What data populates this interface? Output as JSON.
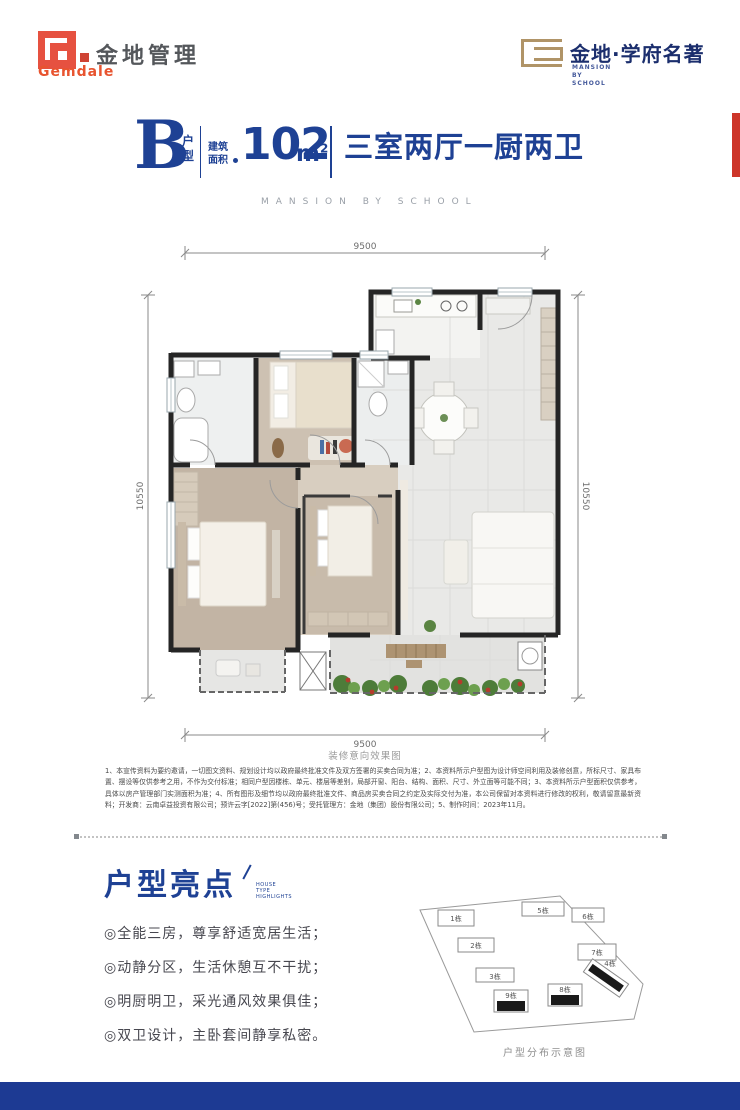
{
  "brand": {
    "gemdale_cn": "金地管理",
    "gemdale_en": "Gemdale",
    "project_name": "金地·学府名著",
    "project_lines": [
      "MANSION",
      "BY",
      "SCHOOL"
    ]
  },
  "title": {
    "type_letter": "B",
    "type_label": "户型",
    "area_label": "建筑面积",
    "area_value": "102",
    "area_unit_base": "m",
    "area_unit_sup": "2",
    "rooms": "三室两厅一厨两卫",
    "subtitle_en": "MANSION BY SCHOOL"
  },
  "floor_plan": {
    "dim_top": "9500",
    "dim_bottom": "9500",
    "dim_left": "10550",
    "dim_right": "10550",
    "caption": "装修意向效果图"
  },
  "disclaimer": {
    "text": "1、本宣传资料为要约邀请，一切图文资料、规划设计均以政府最终批准文件及双方签署的买卖合同为准；2、本资料所示户型图为设计师空间利用及装修创意，所标尺寸、家具布置、摆设等仅供参考之用，不作为交付标准；相同户型因楼栋、单元、楼层等差别，局部开窗、阳台、结构、面积、尺寸、外立面等可能不同；3、本资料所示户型面积仅供参考，具体以房产管理部门实测面积为准；4、所有图形及细节均以政府最终批准文件、商品房买卖合同之约定及实际交付为准，本公司保留对本资料进行修改的权利，敬请留意最新资料；开发商：云南卓益投资有限公司；预许云字[2022]第(456)号；受托管理方：金地（集团）股份有限公司；5、制作时间：2023年11月。"
  },
  "highlights": {
    "title": "户型亮点",
    "sub": [
      "HOUSE",
      "TYPE",
      "HIGHLIGHTS"
    ],
    "items": [
      "◎全能三房，尊享舒适宽居生活；",
      "◎动静分区，生活休憩互不干扰；",
      "◎明厨明卫，采光通风效果俱佳；",
      "◎双卫设计，主卧套间静享私密。"
    ]
  },
  "site_plan": {
    "caption": "户型分布示意图",
    "buildings": [
      "1栋",
      "2栋",
      "3栋",
      "4栋",
      "5栋",
      "6栋",
      "7栋",
      "8栋",
      "9栋"
    ]
  },
  "colors": {
    "accent_blue": "#1e4194",
    "navy": "#1b2e6d",
    "brand_orange": "#e65140",
    "brand_gold": "#b09467",
    "footer_blue": "#1d3a93",
    "red_accent": "#cd3529"
  }
}
